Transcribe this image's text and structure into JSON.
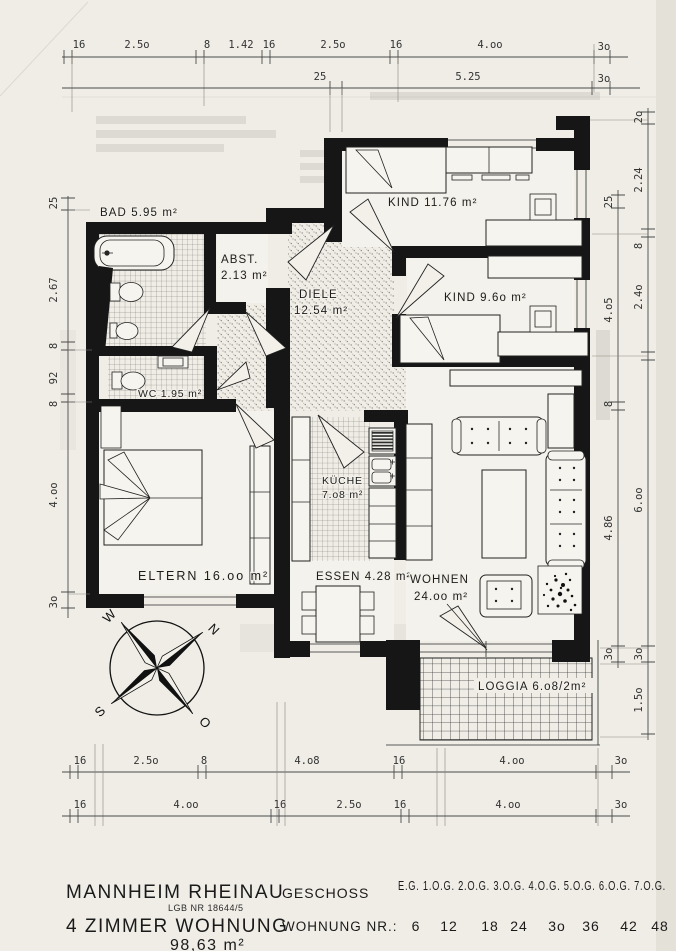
{
  "plan": {
    "rooms": {
      "bad": "BAD 5.95 m²",
      "abst1": "ABST.",
      "abst2": "2.13 m²",
      "diele1": "DIELE",
      "diele2": "12.54 m²",
      "kind1": "KIND 11.76 m²",
      "kind2": "KIND 9.6o m²",
      "wc": "WC 1.95 m²",
      "eltern": "ELTERN 16.oo m²",
      "kueche1": "KÜCHE",
      "kueche2": "7.o8 m²",
      "essen": "ESSEN 4.28 m²",
      "wohnen1": "WOHNEN",
      "wohnen2": "24.oo m²",
      "loggia": "LOGGIA 6.o8/2m²"
    },
    "compass": {
      "n": "N",
      "s": "S",
      "w": "W",
      "o": "O"
    }
  },
  "dims": {
    "top1": [
      "16",
      "2.5o",
      "8",
      "1.42",
      "16",
      "2.5o",
      "16",
      "4.oo",
      "3o"
    ],
    "top2": [
      "25",
      "5.25",
      "3o"
    ],
    "bottom1": [
      "16",
      "2.5o",
      "8",
      "4.o8",
      "16",
      "4.oo",
      "3o"
    ],
    "bottom2": [
      "16",
      "4.oo",
      "16",
      "2.5o",
      "16",
      "4.oo",
      "3o"
    ],
    "left": [
      "25",
      "2.67",
      "8",
      "92",
      "8",
      "4.oo",
      "3o"
    ],
    "right_inner": [
      "25",
      "4.o5",
      "8",
      "4.86",
      "3o"
    ],
    "right_outer": [
      "2o",
      "2.24",
      "8",
      "2.4o",
      "6.oo",
      "3o",
      "1.5o"
    ]
  },
  "title_block": {
    "city": "MANNHEIM RHEINAU",
    "register": "LGB NR 18644/5",
    "type": "4 ZIMMER WOHNUNG",
    "area": "98,63 m²",
    "floor_label": "GESCHOSS",
    "floors": "E.G. 1.O.G. 2.O.G. 3.O.G. 4.O.G. 5.O.G. 6.O.G. 7.O.G.",
    "apartment_label": "WOHNUNG NR.:",
    "apartment_numbers": [
      "6",
      "12",
      "18",
      "24",
      "3o",
      "36",
      "42",
      "48"
    ]
  }
}
